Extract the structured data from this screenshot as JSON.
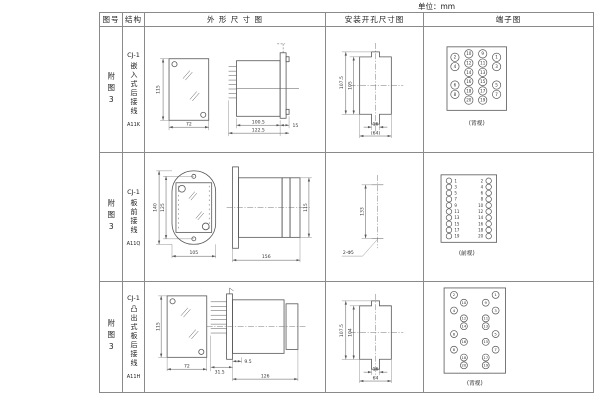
{
  "unit_label": "单位：mm",
  "headers": {
    "fig_no": "图号",
    "structure": "结构",
    "outline": "外 形 尺 寸 图",
    "install": "安装开孔尺寸图",
    "terminal": "端子图"
  },
  "rows": [
    {
      "fig_no": "附图3",
      "model": "CJ-1",
      "desc": "嵌入式后接线",
      "code": "A11K",
      "outline": {
        "front_h": "115",
        "front_w": "72",
        "body_l": "100.5",
        "total_l": "122.5",
        "flange": "15"
      },
      "install": {
        "outer_h": "107.5",
        "inner_h": "105",
        "slot_w": "16",
        "overall_w": "(64)"
      },
      "terminal": {
        "view": "(背视)",
        "grid": [
          [
            2,
            10,
            9,
            1
          ],
          [
            4,
            12,
            11,
            3
          ],
          [
            null,
            14,
            13,
            null
          ],
          [
            6,
            16,
            15,
            5
          ],
          [
            8,
            18,
            17,
            7
          ],
          [
            null,
            20,
            19,
            null
          ]
        ]
      }
    },
    {
      "fig_no": "附图3",
      "model": "CJ-1",
      "desc": "板前接线",
      "code": "A11Q",
      "outline": {
        "front_h": "140",
        "bolt_h": "125",
        "front_w": "105",
        "side_l": "156",
        "side_h": "115"
      },
      "install": {
        "hole_dist": "133",
        "holes": "2-Φ5"
      },
      "terminal": {
        "view": "(前视)",
        "pairs": [
          [
            1,
            2
          ],
          [
            3,
            4
          ],
          [
            5,
            6
          ],
          [
            7,
            8
          ],
          [
            9,
            10
          ],
          [
            11,
            12
          ],
          [
            13,
            14
          ],
          [
            15,
            16
          ],
          [
            17,
            18
          ],
          [
            19,
            20
          ]
        ]
      }
    },
    {
      "fig_no": "附图3",
      "model": "CJ-1",
      "desc": "凸出式板后接线",
      "code": "A11H",
      "outline": {
        "front_h": "115",
        "front_w": "72",
        "pin_l": "31.5",
        "gap": "9.5",
        "body_l": "126"
      },
      "install": {
        "outer_h": "107.5",
        "inner_h": "104",
        "slot_w": "16",
        "overall_w": "64"
      },
      "terminal": {
        "view": "(背视)",
        "slots": [
          [
            "outer",
            2,
            1
          ],
          [
            "inner",
            10,
            9
          ],
          [
            "outer",
            4,
            3
          ],
          [
            "inner",
            12,
            11
          ],
          [
            "inner",
            14,
            13
          ],
          [
            "outer",
            6,
            5
          ],
          [
            "inner",
            16,
            15
          ],
          [
            "outer",
            8,
            7
          ],
          [
            "inner",
            18,
            17
          ],
          [
            "inner",
            20,
            19
          ]
        ]
      }
    }
  ]
}
